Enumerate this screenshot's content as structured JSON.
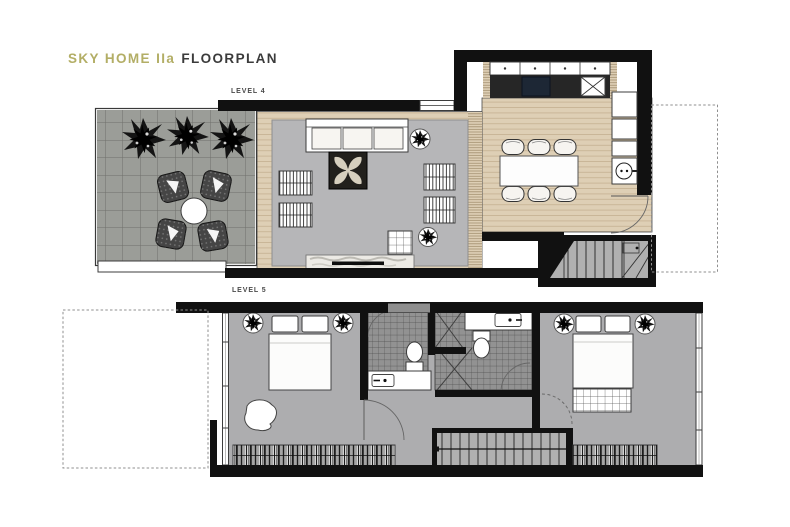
{
  "title": {
    "brand": "SKY HOME IIa",
    "product": "FLOORPLAN"
  },
  "levels": {
    "level4": {
      "label": "LEVEL 4"
    },
    "level5": {
      "label": "LEVEL 5"
    }
  },
  "colors": {
    "brand": "#b3ae66",
    "title": "#3b3b3b",
    "label": "#4a4a4a",
    "wall": "#111111",
    "terrace_tile": "#9b9d98",
    "terrace_grid": "#6f706b",
    "wood": "#decfb5",
    "wood_line": "#c2ae8f",
    "rug": "#b6b6b8",
    "carpet": "#adadaf",
    "tile": "#929292",
    "tile_line": "#4e4e4e",
    "stair": "#b0b0b0",
    "counter": "#262626",
    "cooktop": "#1d2735",
    "fixture": "#ffffff",
    "dash": "#8f8f8f"
  }
}
